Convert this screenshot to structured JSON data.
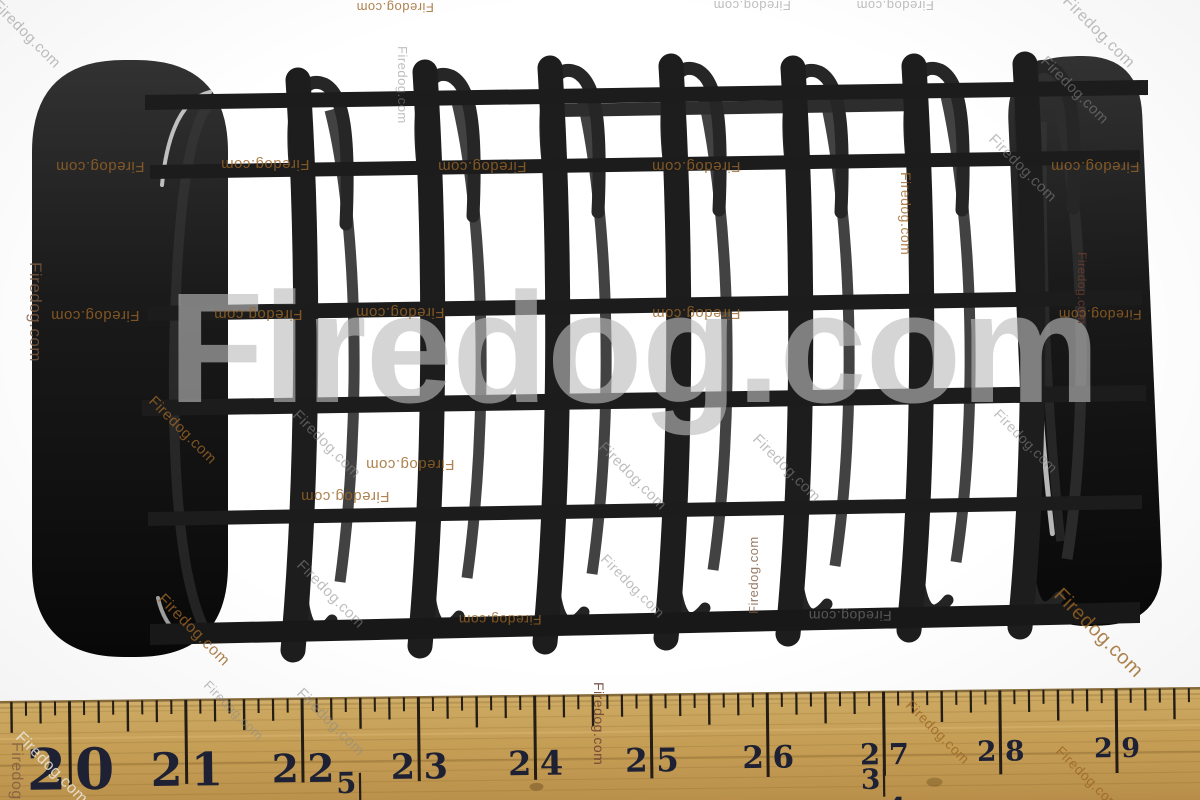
{
  "watermark": {
    "text": "Firedog.com",
    "big": {
      "color": "#bcbcbc",
      "opacity": 0.62
    },
    "styles": {
      "orange": {
        "color": "#9a6526",
        "opacity": 0.8
      },
      "gray": {
        "color": "#8a8a8a",
        "opacity": 0.55
      },
      "white": {
        "color": "#ece8df",
        "opacity": 0.85
      },
      "maroon": {
        "color": "#6a3c30",
        "opacity": 0.85
      },
      "brown": {
        "color": "#7d5a40",
        "opacity": 0.8
      }
    }
  },
  "ruler": {
    "inch_labels": [
      "20",
      "21",
      "22",
      "23",
      "24",
      "25",
      "26",
      "27",
      "28",
      "29"
    ],
    "fractions": [
      {
        "numerator": "5",
        "denominator": "8"
      },
      {
        "numerator": "3",
        "denominator": "4"
      }
    ],
    "wood_color": "#c49c54",
    "marking_color": "#241d15",
    "numeral_color": "#1d2133"
  },
  "photo_colors": {
    "background": "#ffffff",
    "part_black": "#1b1b1b"
  }
}
